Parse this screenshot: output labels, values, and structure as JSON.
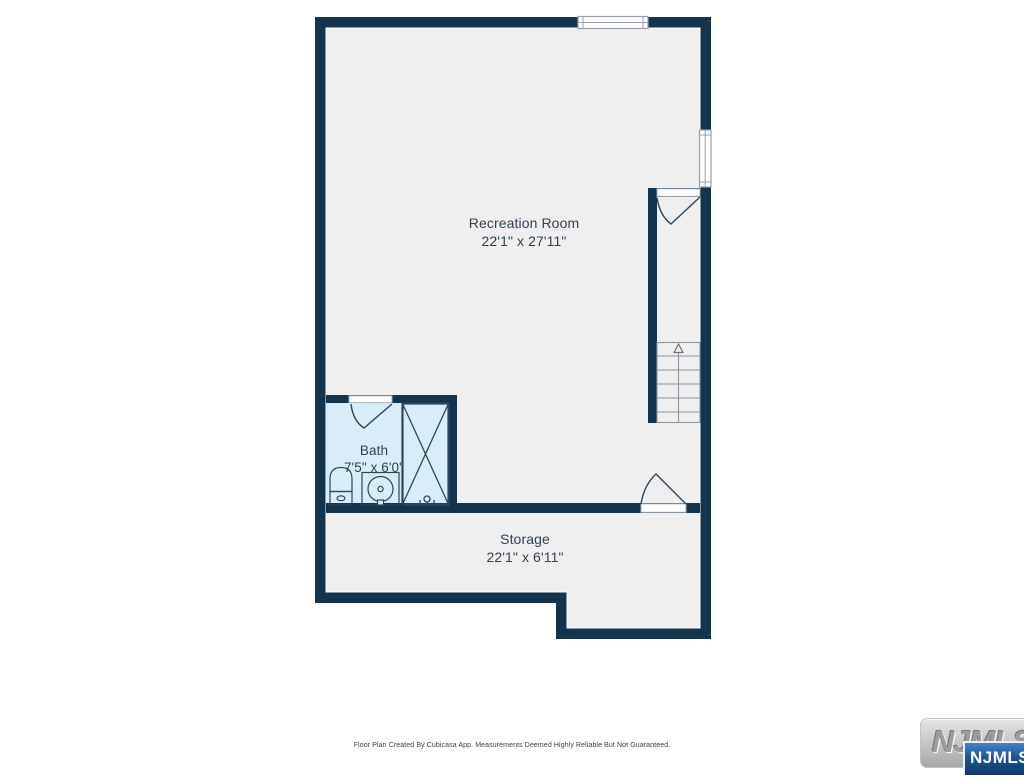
{
  "floor_plan": {
    "rooms": [
      {
        "id": "recreation-room",
        "name": "Recreation Room",
        "dimensions": "22'1\" x 27'11\""
      },
      {
        "id": "bath",
        "name": "Bath",
        "dimensions": "7'5\" x 6'0\""
      },
      {
        "id": "storage",
        "name": "Storage",
        "dimensions": "22'1\" x 6'11\""
      }
    ],
    "features": [
      "window-top-wall",
      "window-right-wall",
      "staircase-up-arrow",
      "door-to-stairwell",
      "door-to-storage",
      "door-to-bath",
      "toilet",
      "sink-vanity",
      "shower"
    ],
    "colors": {
      "wall": "#14334c",
      "floor": "#efeff0",
      "bath_floor": "#d9edf8",
      "label_text": "#2f4256",
      "stair_tread": "#8e969e",
      "fixture_stroke": "#2a4660"
    }
  },
  "footer": {
    "disclaimer": "Floor Plan Created By Cubicasa App. Measurements Deemed Highly Reliable But Not Guaranteed."
  },
  "watermark": {
    "logo_text": "NJMLS",
    "badge_text": "NJMLS",
    "badge_color": "#0b3a6c"
  }
}
